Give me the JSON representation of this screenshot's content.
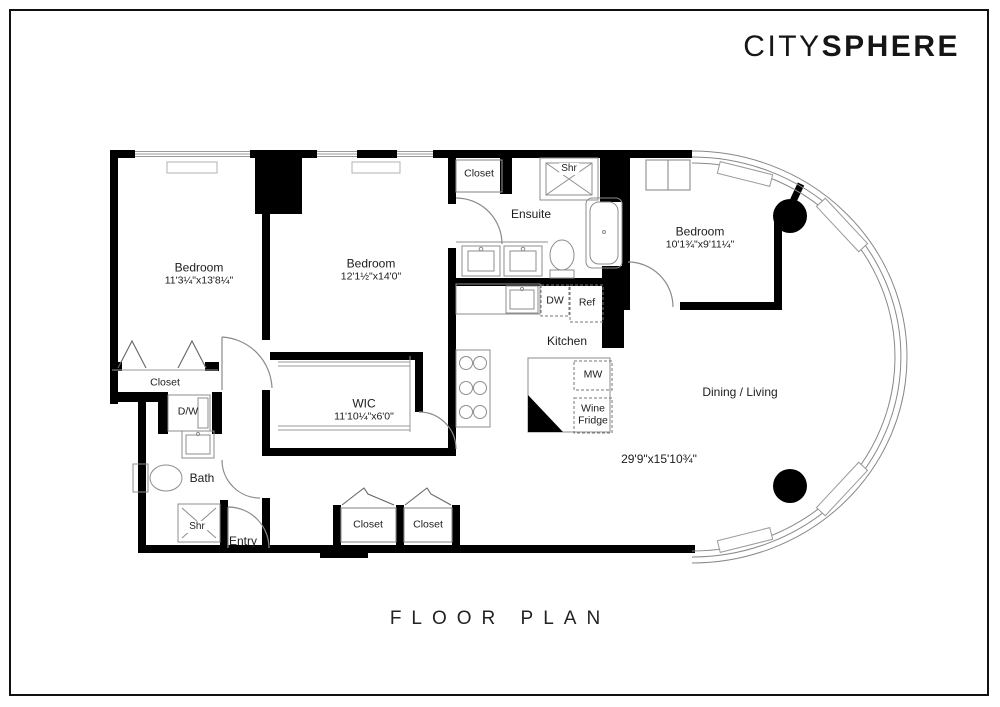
{
  "brand": {
    "light": "CITY",
    "bold": "SPHERE"
  },
  "title": "FLOOR PLAN",
  "rooms": {
    "bedroom1": {
      "name": "Bedroom",
      "dims": "11'3¼\"x13'8¼\""
    },
    "bedroom2": {
      "name": "Bedroom",
      "dims": "12'1½\"x14'0\""
    },
    "bedroom3": {
      "name": "Bedroom",
      "dims": "10'1¾\"x9'11¼\""
    },
    "wic": {
      "name": "WIC",
      "dims": "11'10¼\"x6'0\""
    },
    "ensuite": {
      "name": "Ensuite"
    },
    "kitchen": {
      "name": "Kitchen"
    },
    "dining_living": {
      "name": "Dining / Living",
      "dims": "29'9\"x15'10¾\""
    },
    "bath": {
      "name": "Bath"
    },
    "entry": {
      "name": "Entry"
    }
  },
  "fixtures": {
    "closet": "Closet",
    "shower": "Shr",
    "washer_dryer": "D/W",
    "dishwasher": "DW",
    "refrigerator": "Ref",
    "microwave": "MW",
    "wine_fridge": "Wine Fridge"
  },
  "colors": {
    "wall": "#000000",
    "fixture_line": "#8d8d8d",
    "background": "#ffffff",
    "text": "#1c1c1c"
  }
}
